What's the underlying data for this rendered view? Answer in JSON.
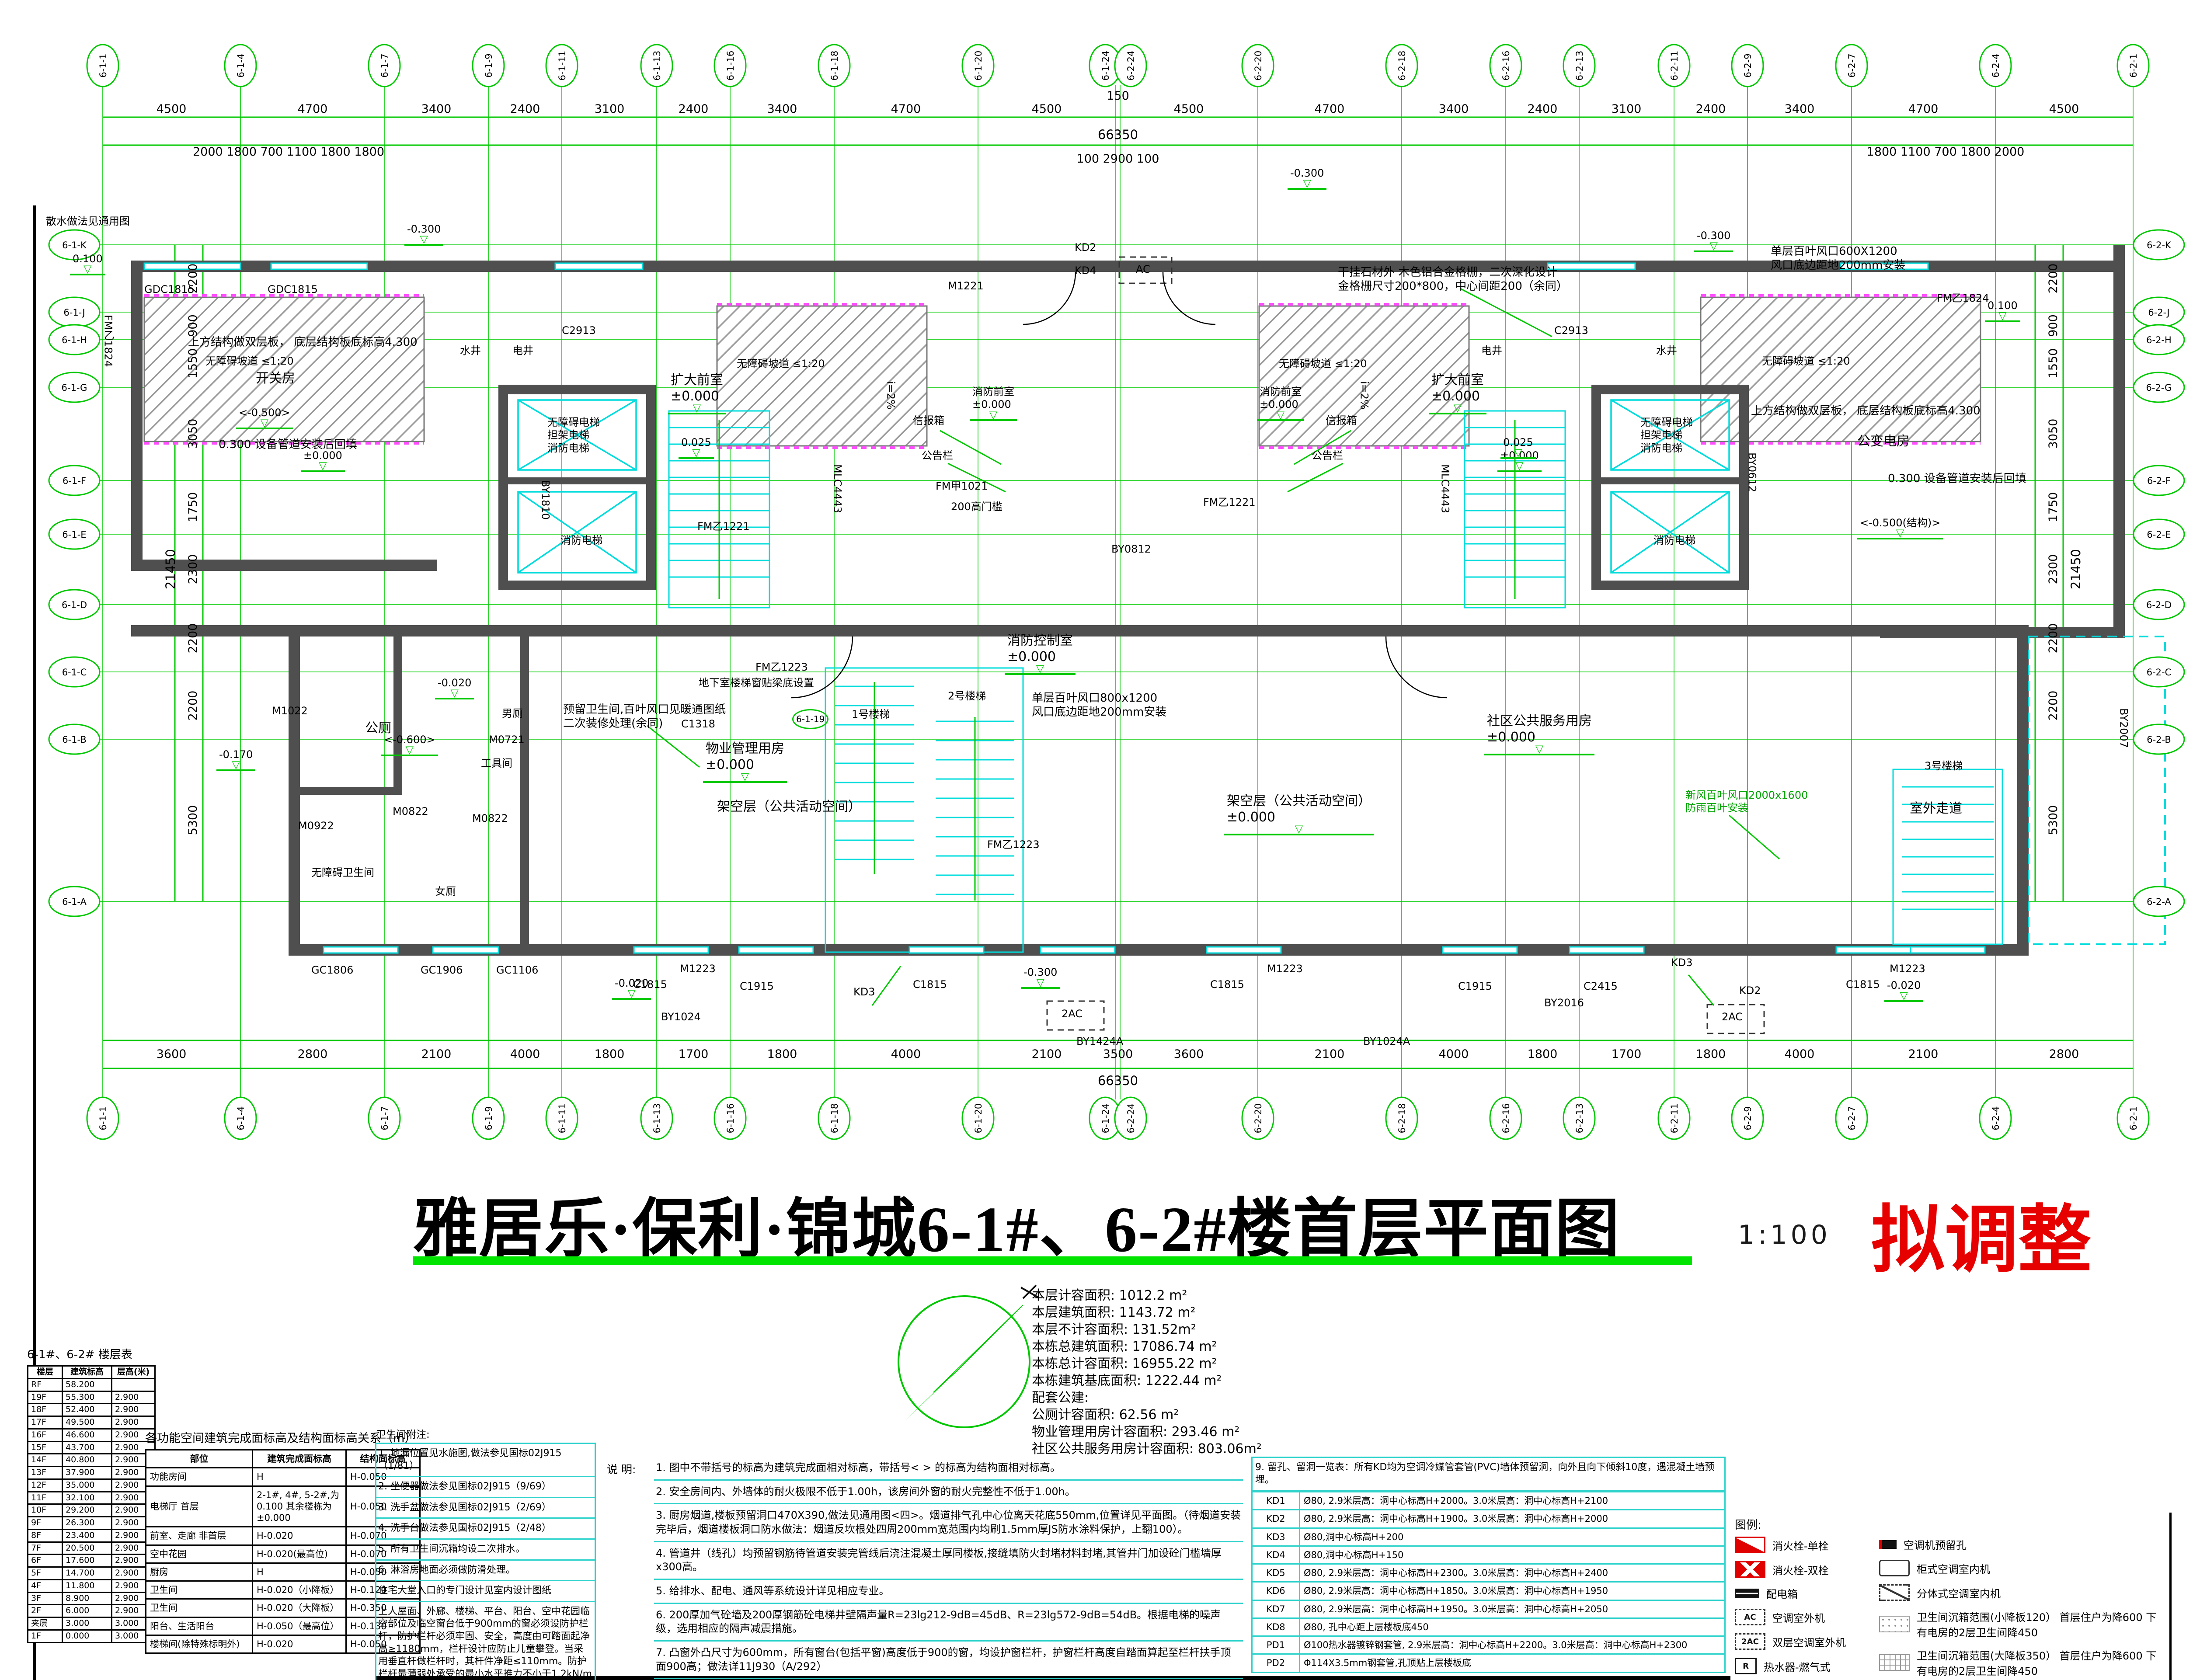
{
  "sheet": {
    "title": "雅居乐·保利·锦城6-1#、6-2#楼首层平面图",
    "scale_label": "1:100",
    "stamp": "拟调整"
  },
  "area_stats": {
    "lines": [
      "本层计容面积: 1012.2 m²",
      "本层建筑面积: 1143.72 m²",
      "本层不计容面积: 131.52m²",
      "本栋总建筑面积: 17086.74 m²",
      "本栋总计容面积: 16955.22 m²",
      "本栋建筑基底面积: 1222.44 m²",
      "配套公建:",
      "公厕计容面积:  62.56 m²",
      "物业管理用房计容面积:  293.46 m²",
      "社区公共服务用房计容面积: 803.06m²"
    ]
  },
  "floor_table": {
    "title": "6-1#、6-2# 楼层表",
    "headers": [
      "楼层",
      "建筑标高",
      "层高(米)"
    ],
    "rows": [
      [
        "RF",
        "58.200",
        ""
      ],
      [
        "19F",
        "55.300",
        "2.900"
      ],
      [
        "18F",
        "52.400",
        "2.900"
      ],
      [
        "17F",
        "49.500",
        "2.900"
      ],
      [
        "16F",
        "46.600",
        "2.900"
      ],
      [
        "15F",
        "43.700",
        "2.900"
      ],
      [
        "14F",
        "40.800",
        "2.900"
      ],
      [
        "13F",
        "37.900",
        "2.900"
      ],
      [
        "12F",
        "35.000",
        "2.900"
      ],
      [
        "11F",
        "32.100",
        "2.900"
      ],
      [
        "10F",
        "29.200",
        "2.900"
      ],
      [
        "9F",
        "26.300",
        "2.900"
      ],
      [
        "8F",
        "23.400",
        "2.900"
      ],
      [
        "7F",
        "20.500",
        "2.900"
      ],
      [
        "6F",
        "17.600",
        "2.900"
      ],
      [
        "5F",
        "14.700",
        "2.900"
      ],
      [
        "4F",
        "11.800",
        "2.900"
      ],
      [
        "3F",
        "8.900",
        "2.900"
      ],
      [
        "2F",
        "6.000",
        "2.900"
      ],
      [
        "夹层",
        "3.000",
        "3.000"
      ],
      [
        "1F",
        "0.000",
        "3.000"
      ]
    ]
  },
  "finish_table": {
    "title": "各功能空间建筑完成面标高及结构面标高关系（m）",
    "headers": [
      "部位",
      "建筑完成面标高",
      "结构面标高"
    ],
    "rows": [
      [
        "功能房间",
        "H",
        "H-0.050"
      ],
      [
        "电梯厅  首层",
        "2-1#, 4#, 5-2#,为0.100 其余楼栋为±0.000",
        "H-0.050"
      ],
      [
        "前室、走廊  非首层",
        "H-0.020",
        "H-0.070"
      ],
      [
        "空中花园",
        "H-0.020(最高位)",
        "H-0.070"
      ],
      [
        "厨房",
        "H",
        "H-0.050"
      ],
      [
        "卫生间",
        "H-0.020（小降板）",
        "H-0.120"
      ],
      [
        "卫生间",
        "H-0.020（大降板）",
        "H-0.350"
      ],
      [
        "阳台、生活阳台",
        "H-0.050（最高位）",
        "H-0.130"
      ],
      [
        "楼梯间(除特殊标明外)",
        "H-0.020",
        "H-0.050"
      ]
    ]
  },
  "toilet_notes": {
    "title": "卫生间附注:",
    "items": [
      "1. 地漏位置见水施图,做法参见国标02J915（1/81）",
      "2. 坐便器做法参见国标02J915（9/69）",
      "3. 洗手盆做法参见国标02J915（2/69）",
      "4. 洗手台做法参见国标02J915（2/48）",
      "5. 所有卫生间沉箱均设二次排水。",
      "6. 淋浴房地面必须做防滑处理。",
      "住宅大堂入口的专门设计见室内设计图纸",
      "上人屋面、外廊、楼梯、平台、阳台、空中花园临空部位及临空窗台低于900mm的窗必须设防护栏杆，防护栏杆必须牢固、安全，高度由可踏面起净高≥1180mm，栏杆设计应防止儿童攀登。当采用垂直杆做栏杆时，其杆件净距≤110mm。防护栏杆最薄弱处承受的最小水平推力不小于1.2kN/m"
    ]
  },
  "notes": {
    "label": "说 明:",
    "items": [
      "1. 图中不带括号的标高为建筑完成面相对标高，带括号< > 的标高为结构面相对标高。",
      "2. 安全房间内、外墙体的耐火极限不低于1.00h，该房间外窗的耐火完整性不低于1.00h。",
      "3. 厨房烟道,楼板预留洞口470X390,做法见通用图<四>。烟道排气孔中心位离天花底550mm,位置详见平面图。（待烟道安装完毕后，烟道楼板洞口防水做法：烟道反坎根处四周200mm宽范围内均刷1.5mm厚JS防水涂料保护，上翻100）。",
      "4. 管道井（线孔）均预留钢筋待管道安装完管线后浇注混凝土厚同楼板,接缝填防火封堵材料封堵,其管井门加设砼门槛墙厚x300高。",
      "5. 给排水、配电、通风等系统设计详见相应专业。",
      "6. 200厚加气砼墙及200厚钢筋砼电梯井壁隔声量R=23lg212-9dB=45dB、R=23lg572-9dB=54dB。根据电梯的噪声级，选用相应的隔声减震措施。",
      "7. 凸窗外凸尺寸为600mm，所有窗台(包括平窗)高度低于900的窗，均设护窗栏杆，护窗栏杆高度自踏面算起至栏杆扶手顶面900高；做法详11J930（A/292）",
      "8. 套内卫生间管井设检修口的楼层:设两个200X200检修孔,高度同检修口（淋浴龙头设于水管井的,检修口底高1200），首层装饰柱内污废水管设检修孔(优选内侧)。",
      "9. 门垛距离除标明外为50mm或100mm或居中设置。"
    ]
  },
  "kd_table": {
    "intro": "9. 留孔、留洞一览表：所有KD均为空调冷媒管套管(PVC)墙体预留洞，向外且向下倾斜10度，遇混凝土墙预埋。",
    "rows": [
      [
        "KD1",
        "Ø80, 2.9米层高：洞中心标高H+2000。3.0米层高：洞中心标高H+2100"
      ],
      [
        "KD2",
        "Ø80, 2.9米层高：洞中心标高H+1900。3.0米层高：洞中心标高H+2000"
      ],
      [
        "KD3",
        "Ø80,洞中心标高H+200"
      ],
      [
        "KD4",
        "Ø80,洞中心标高H+150"
      ],
      [
        "KD5",
        "Ø80, 2.9米层高：洞中心标高H+2300。3.0米层高：洞中心标高H+2400"
      ],
      [
        "KD6",
        "Ø80, 2.9米层高：洞中心标高H+1850。3.0米层高：洞中心标高H+1950"
      ],
      [
        "KD7",
        "Ø80, 2.9米层高：洞中心标高H+1950。3.0米层高：洞中心标高H+2050"
      ],
      [
        "KD8",
        "Ø80, 孔中心距上层楼板底450"
      ],
      [
        "PD1",
        "Ø100热水器镀锌钢套管, 2.9米层高：洞中心标高H+2200。3.0米层高：洞中心标高H+2300"
      ],
      [
        "PD2",
        "Φ114X3.5mm钢套管,孔顶贴上层楼板底"
      ]
    ]
  },
  "legend": {
    "title": "图例:",
    "items_left": [
      {
        "glyph": "",
        "label": "消火栓-单栓"
      },
      {
        "glyph": "",
        "label": "消火栓-双栓"
      },
      {
        "glyph": "",
        "label": "配电箱"
      },
      {
        "glyph": "AC",
        "label": "空调室外机"
      },
      {
        "glyph": "2AC",
        "label": "双层空调室外机"
      },
      {
        "glyph": "R",
        "label": "热水器-燃气式"
      }
    ],
    "items_right": [
      {
        "glyph": "",
        "label": "空调机预留孔"
      },
      {
        "glyph": "",
        "label": "柜式空调室内机"
      },
      {
        "glyph": "",
        "label": "分体式空调室内机"
      },
      {
        "glyph": "",
        "label": "卫生间沉箱范围(小降板120） 首层住户为降600  下有电房的2层卫生间降450"
      },
      {
        "glyph": "",
        "label": "卫生间沉箱范围(大降板350） 首层住户为降600  下有电房的2层卫生间降450"
      },
      {
        "glyph": "",
        "label": "首层结构降板H-0.60"
      }
    ]
  },
  "axes": {
    "top": [
      "6-1-1",
      "6-1-4",
      "6-1-7",
      "6-1-9",
      "6-1-11",
      "6-1-13",
      "6-1-16",
      "6-1-18",
      "6-1-20",
      "6-1-24",
      "6-2-24",
      "6-2-20",
      "6-2-18",
      "6-2-16",
      "6-2-13",
      "6-2-11",
      "6-2-9",
      "6-2-7",
      "6-2-4",
      "6-2-1"
    ],
    "left": [
      "6-1-K",
      "6-1-J",
      "6-1-H",
      "6-1-G",
      "6-1-F",
      "6-1-E",
      "6-1-D",
      "6-1-C",
      "6-1-B",
      "6-1-A"
    ],
    "right": [
      "6-2-K",
      "6-2-J",
      "6-2-H",
      "6-2-G",
      "6-2-F",
      "6-2-E",
      "6-2-D",
      "6-2-C",
      "6-2-B",
      "6-2-A"
    ]
  },
  "dims": {
    "top": [
      "4500",
      "4700",
      "3400",
      "2400",
      "3100",
      "2400",
      "3400",
      "4700",
      "4500",
      "150",
      "4500",
      "4700",
      "3400",
      "2400",
      "3100",
      "2400",
      "3400",
      "4700",
      "4500"
    ],
    "bottom": [
      "3600",
      "2800",
      "2100",
      "4000",
      "1800",
      "1700",
      "1800",
      "4000",
      "2100",
      "3500",
      "3600",
      "2100",
      "4000",
      "1800",
      "1700",
      "1800",
      "4000",
      "2100",
      "2800"
    ],
    "left": [
      "2200",
      "900",
      "1550",
      "3050",
      "1750",
      "2300",
      "2200",
      "2200",
      "5300"
    ],
    "right": [
      "2200",
      "900",
      "1550",
      "3050",
      "1750",
      "2300",
      "2200",
      "2200",
      "5300"
    ],
    "minor_left": "2000 1800 700 1100 1800 1800",
    "minor_center": "100 2900 100",
    "minor_right": "1800 1100 700 1800 2000",
    "total_h": "66350",
    "total_v": "21450"
  },
  "plan": {
    "labels": {
      "splash": "散水做法见通用图",
      "upper_slab_l": "上方结构做双层板， 底层结构板底标高4.300",
      "switch_room": "开关房",
      "backfill_l": "0.300 设备管道安装后回填",
      "lvl_n500_l": "<-0.500>",
      "gdc1815_a": "GDC1815",
      "gdc1815_b": "GDC1815",
      "fm1824_l": "FM乙1824",
      "fm1824_r": "FM乙1824",
      "water_l": "水井",
      "elec_l": "电井",
      "water_r": "水井",
      "elec_r": "电井",
      "c2913_l": "C2913",
      "c2913_r": "C2913",
      "lobby_l": "扩大前室\n±0.000",
      "lobby_r": "扩大前室\n±0.000",
      "fire_lobby_l": "消防前室\n±0.000",
      "fire_lobby_r": "消防前室\n±0.000",
      "fire_ctrl": "消防控制室\n±0.000",
      "louver_c": "单层百叶风口800x1200\n风口底边距地200mm安装",
      "louver_r": "单层百叶风口600X1200\n风口底边距地200mm安装",
      "stone": "干挂石材外 木色铝合金格栅，二次深化设计\n金格栅尺寸200*800，中心间距200（余同）",
      "ramp_l": "无障碍坡道 ≤1:20",
      "ramp_cl": "无障碍坡道 ≤1:20",
      "ramp_cr": "无障碍坡道 ≤1:20",
      "ramp_r": "无障碍坡道 ≤1:20",
      "mail_l": "信报箱",
      "mail_r": "信报箱",
      "board_l": "公告栏",
      "board_r": "公告栏",
      "mlc_l": "MLC4443",
      "mlc_r": "MLC4443",
      "slope_l": "i=2%",
      "slope_r": "i=2%",
      "stilt_l": "架空层（公共活动空间）",
      "stilt_r": "架空层（公共活动空间）\n±0.000",
      "lvl0_a": "±0.000",
      "lvl0_b": "±0.000",
      "n300_a": "-0.300",
      "n300_b": "-0.300",
      "n300_c": "-0.300",
      "n300_d": "-0.300",
      "n020_a": "-0.020",
      "n020_b": "-0.020",
      "n020_c": "-0.020",
      "n600": "<-0.600>",
      "n170": "-0.170",
      "p100_l": "0.100",
      "p100_r": "0.100",
      "p025_l": "0.025",
      "p025_r": "0.025",
      "wc": "公厕",
      "wc_m": "男厕",
      "wc_f": "女厕",
      "tool": "工具间",
      "wc_acc": "无障碍卫生间",
      "m0721": "M0721",
      "m0822": "M0822",
      "m0822b": "M0822",
      "m0922": "M0922",
      "m1022": "M1022",
      "gc1806": "GC1806",
      "gc1906": "GC1906",
      "gc1106": "GC1106",
      "reserve": "预留卫生间,百叶风口见暖通图纸\n二次装修处理(余同)",
      "property": "物业管理用房\n±0.000",
      "community": "社区公共服务用房\n±0.000",
      "stair1": "1号楼梯",
      "stair2": "2号楼梯",
      "stair3": "3号楼梯",
      "elev_l1": "无障碍电梯\n担架电梯\n消防电梯",
      "elev_l2": "消防电梯",
      "elev_r1": "无障碍电梯\n担架电梯\n消防电梯",
      "elev_r2": "消防电梯",
      "basement": "地下室楼梯窗贴梁底设置",
      "axisref": "6-1-19",
      "fmz1223_a": "FM乙1223",
      "fmz1223_b": "FM乙1223",
      "fmz1221_a": "FM乙1221",
      "fmz1221_b": "FM乙1221",
      "fmj1021": "FM甲1021",
      "sill": "200高门槛",
      "m1221": "M1221",
      "kd2_a": "KD2",
      "kd2_b": "KD2",
      "kd4": "KD4",
      "kd3_a": "KD3",
      "kd3_b": "KD3",
      "c1318": "C1318",
      "c1815_a": "C1815",
      "c1815_b": "C1815",
      "c1815_c": "C1815",
      "c1815_d": "C1815",
      "c1915_a": "C1915",
      "c1915_b": "C1915",
      "c2415": "C2415",
      "m1223_a": "M1223",
      "m1223_b": "M1223",
      "m1223_c": "M1223",
      "by1424a": "BY1424A",
      "by1024a": "BY1024A",
      "by1024": "BY1024",
      "by2016": "BY2016",
      "by2007": "BY2007",
      "by0612": "BY0612",
      "by0812": "BY0812",
      "by1810": "BY1810",
      "outdoor": "室外走道",
      "transformer": "公变电房",
      "upper_slab_r": "上方结构做双层板， 底层结构板底标高4.300",
      "backfill_r": "0.300 设备管道安装后回填",
      "lvl_n500_r": "<-0.500(结构)>",
      "fresh_air": "新风百叶风口2000x1600\n防雨百叶安装",
      "ac_top": "AC",
      "ac2_a": "2AC",
      "ac2_b": "2AC"
    }
  }
}
